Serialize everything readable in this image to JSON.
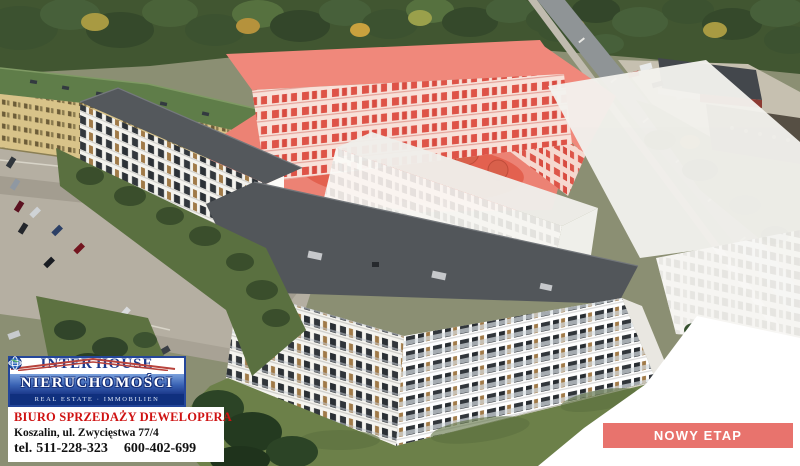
{
  "branding": {
    "name_part1": "INTER",
    "name_part2": "HOUSE",
    "name_line2": "NIERUCHOMOŚCI",
    "tagline": "REAL ESTATE · IMMOBILIEN"
  },
  "contact": {
    "office_label": "BIURO SPRZEDAŻY DEWELOPERA",
    "address": "Koszalin, ul. Zwycięstwa 77/4",
    "phone_prefix": "tel.",
    "phone_1": "511-228-323",
    "phone_2": "600-402-699"
  },
  "cta": {
    "label": "NOWY ETAP"
  },
  "colors": {
    "brand_blue": "#1c3a8c",
    "brand_red": "#b8433c",
    "office_text_red": "#cf1212",
    "cta_background": "#e8736d",
    "cta_text": "#ffffff",
    "new_phase_highlight": "#f0887b"
  }
}
